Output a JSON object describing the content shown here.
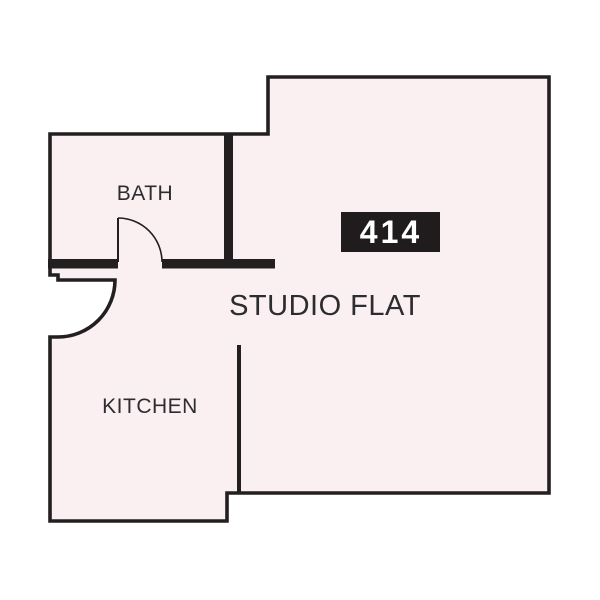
{
  "floorplan": {
    "unit_badge": "414",
    "unit_type_label": "STUDIO FLAT",
    "rooms": [
      {
        "label": "BATH"
      },
      {
        "label": "KITCHEN"
      }
    ],
    "colors": {
      "floor-fill": "#faf0f1",
      "wall": "#231f20",
      "label-text": "#2d2c31",
      "badge-bg": "#201c1d",
      "badge-text": "#ffffff",
      "page-background": "#ffffff"
    }
  }
}
